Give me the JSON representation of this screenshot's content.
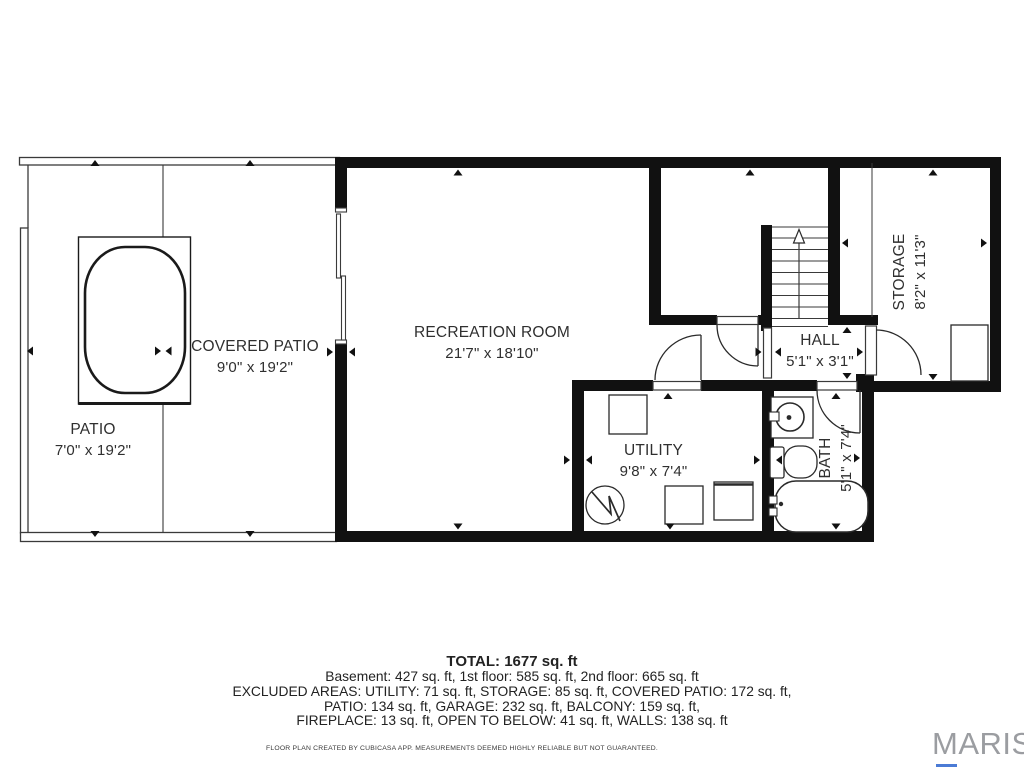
{
  "floor_plan": {
    "rooms": {
      "patio": {
        "name": "PATIO",
        "dims": "7'0\" x 19'2\""
      },
      "covered_patio": {
        "name": "COVERED PATIO",
        "dims": "9'0\" x 19'2\""
      },
      "recreation": {
        "name": "RECREATION ROOM",
        "dims": "21'7\" x 18'10\""
      },
      "utility": {
        "name": "UTILITY",
        "dims": "9'8\" x 7'4\""
      },
      "hall": {
        "name": "HALL",
        "dims": "5'1\" x 3'1\""
      },
      "bath": {
        "name": "BATH",
        "dims": "5'1\" x 7'4\""
      },
      "storage": {
        "name": "STORAGE",
        "dims": "8'2\" x 11'3\""
      }
    },
    "summary": {
      "total": "TOTAL: 1677 sq. ft",
      "floors": "Basement: 427 sq. ft, 1st floor: 585 sq. ft, 2nd floor: 665 sq. ft",
      "excluded1": "EXCLUDED AREAS: UTILITY: 71 sq. ft, STORAGE: 85 sq. ft, COVERED PATIO: 172 sq. ft,",
      "excluded2": "PATIO: 134 sq. ft, GARAGE: 232 sq. ft, BALCONY: 159 sq. ft,",
      "excluded3": "FIREPLACE: 13 sq. ft, OPEN TO BELOW: 41 sq. ft, WALLS: 138 sq. ft"
    },
    "disclaimer": "FLOOR PLAN CREATED BY CUBICASA APP. MEASUREMENTS DEEMED HIGHLY RELIABLE BUT NOT GUARANTEED.",
    "brand": "MARIS",
    "colors": {
      "wall": "#111111",
      "thin_line": "#3a3a3a",
      "text": "#2f2f2f",
      "brand": "#9b9da1",
      "brand_accent": "#4b7bd5"
    }
  }
}
